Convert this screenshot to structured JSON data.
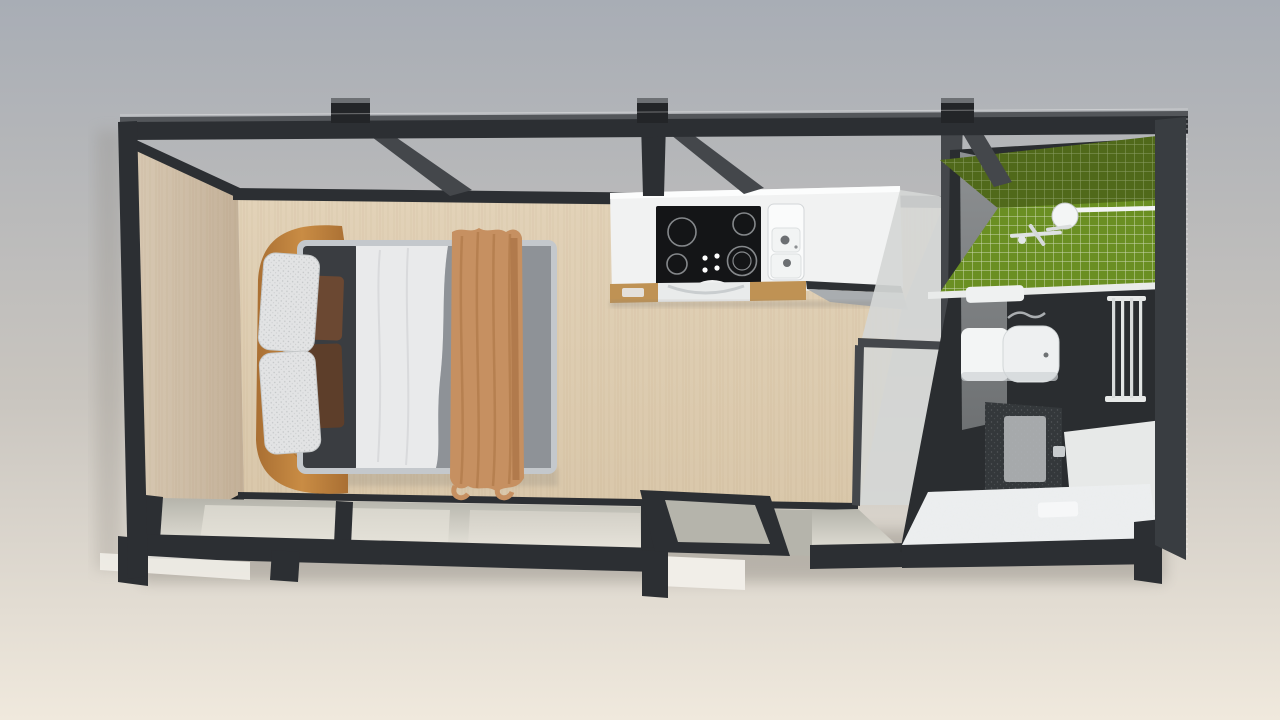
{
  "scene": {
    "view": "top-down-3d-render",
    "rooms": [
      {
        "id": "bedroom",
        "objects": [
          "double-bed",
          "curved-headboard-bench",
          "white-pillows",
          "brown-accent-pillows",
          "dark-duvet",
          "white-sheet",
          "gray-duvet",
          "tan-throw-blanket"
        ]
      },
      {
        "id": "kitchen",
        "objects": [
          "white-countertop",
          "black-cooktop-4-burners",
          "double-basin-sink",
          "wood-cabinet-fronts",
          "oven",
          "dishwasher"
        ]
      },
      {
        "id": "bathroom",
        "objects": [
          "green-mosaic-tile-wall",
          "shower-head",
          "shower-mixer",
          "toilet",
          "dark-vanity-cabinet",
          "towel-radiator",
          "panel-radiator",
          "white-fluffy-rug",
          "bath-mat",
          "frosted-glass-partition",
          "concrete-wall"
        ]
      }
    ],
    "structure": [
      "black-steel-frame",
      "top-beam",
      "joist-stubs",
      "diagonal-braces",
      "left-wood-wall",
      "wood-floor",
      "glass-window-wall",
      "sliding-glass-door",
      "right-dark-wall"
    ]
  },
  "colors": {
    "bg_top": "#a8adb5",
    "bg_mid": "#c9c5bf",
    "bg_bot": "#f0e9dd",
    "frame": "#2c2f33",
    "frame_light": "#53565a",
    "frame_dark": "#232528",
    "stub_top": "#6d7074",
    "wood_wall": "#d7c8b2",
    "wood_wall_dark": "#c3b098",
    "floor": "#d9c7aa",
    "floor_light": "#e2d2b8",
    "grain": "#8a6a3e",
    "glass": "#b5b4ab",
    "glass_light": "#e6e3da",
    "sill_white": "#f1eee8",
    "mattress": "#c4c8cc",
    "duvet_dark": "#3a3d41",
    "sheet": "#e9eaeb",
    "duvet_gray": "#8e9297",
    "pillow_white": "#e2e3e4",
    "pillow_brown": "#6b4832",
    "pillow_brown2": "#5d3e2a",
    "headboard": "#c98c44",
    "headboard_dark": "#a96f33",
    "throw": "#c69061",
    "throw_dark": "#a97244",
    "counter": "#f1f2f2",
    "counter_shade": "#dcdedd",
    "cooktop": "#141517",
    "ring": "#85888b",
    "cab_wood": "#bf9254",
    "appliance_dark": "#2e3134",
    "appliance_glass": "#a9adb0",
    "partition_glass": "#d5d7d6",
    "partition_frame": "#44474b",
    "concrete": "#8d9092",
    "concrete_dark": "#6e7173",
    "tile_green": "#6a8f22",
    "tile_green_dark": "#50691a",
    "grout": "#dde5cc",
    "bath_dark": "#2a2d30",
    "bath_darker": "#1e2124",
    "white_fixture": "#f3f5f5",
    "fixture_shade": "#c9cdd0",
    "vanity": "#34383b",
    "vanity_panel": "#b2b6b8",
    "radiator": "#e7e9e8",
    "rug": "#edeff0",
    "rug_shade": "#d6dadc",
    "shadow": "#8b867e",
    "right_wall": "#393d41"
  }
}
